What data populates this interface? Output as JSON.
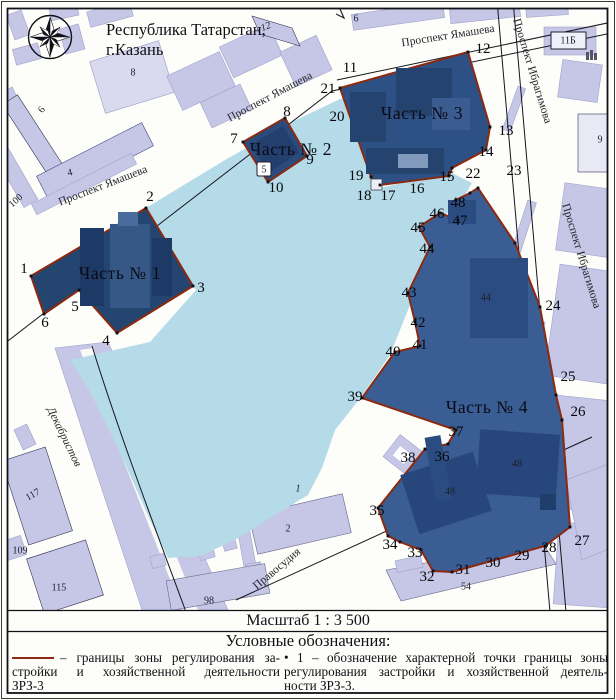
{
  "title": {
    "line1": "Республика Татарстан,",
    "line2": "г.Казань"
  },
  "scale_label": "Масштаб 1 : 3 500",
  "legend": {
    "title": "Условные обозначения:",
    "left_lines": [
      "– границы зоны регулирования за-",
      "стройки и хозяйственной деятельности",
      "ЗРЗ-3"
    ],
    "right_lines": [
      "• 1 – обозначение характерной точки границы зоны",
      "регулирования застройки и хозяйственной деятель-",
      "ности ЗРЗ-3."
    ]
  },
  "colors": {
    "zone_boundary": "#8b2a10",
    "zone_fill_1": "#24456f",
    "zone_fill_2": "#2a4b7c",
    "zone_fill_3": "#2d5085",
    "zone_fill_4": "#3a5d94",
    "city_block": "#c6c6e6",
    "open_area": "#b5dbe8"
  },
  "map": {
    "zones": [
      [
        "Часть № 1",
        120,
        273
      ],
      [
        "Часть № 2",
        291,
        149
      ],
      [
        "Часть № 3",
        422,
        113
      ],
      [
        "Часть № 4",
        487,
        407
      ]
    ],
    "streets": [
      [
        "Проспект Ямашева",
        103,
        186,
        -21,
        false
      ],
      [
        "Проспект Ямашева",
        270,
        97,
        -28,
        false
      ],
      [
        "Проспект Ямашева",
        448,
        36,
        -9,
        false
      ],
      [
        "Проспект Ибрагимова",
        532,
        71,
        73,
        false
      ],
      [
        "Проспект Ибрагимова",
        581,
        256,
        73,
        false
      ],
      [
        "Декабристов",
        64,
        437,
        64,
        true
      ],
      [
        "Правосудия",
        277,
        569,
        -40,
        false
      ]
    ],
    "points": [
      [
        "1",
        24,
        269
      ],
      [
        "2",
        150,
        197
      ],
      [
        "3",
        201,
        288
      ],
      [
        "4",
        106,
        341
      ],
      [
        "5",
        75,
        307
      ],
      [
        "6",
        45,
        323
      ],
      [
        "7",
        234,
        139
      ],
      [
        "8",
        287,
        112
      ],
      [
        "9",
        310,
        160
      ],
      [
        "10",
        276,
        188
      ],
      [
        "11",
        350,
        68
      ],
      [
        "12",
        483,
        49
      ],
      [
        "13",
        506,
        131
      ],
      [
        "14",
        486,
        152
      ],
      [
        "15",
        447,
        177
      ],
      [
        "16",
        417,
        189
      ],
      [
        "17",
        388,
        196
      ],
      [
        "18",
        364,
        196
      ],
      [
        "19",
        356,
        176
      ],
      [
        "20",
        337,
        117
      ],
      [
        "21",
        328,
        89
      ],
      [
        "22",
        473,
        174
      ],
      [
        "23",
        514,
        171
      ],
      [
        "24",
        553,
        306
      ],
      [
        "25",
        568,
        377
      ],
      [
        "26",
        578,
        412
      ],
      [
        "27",
        582,
        541
      ],
      [
        "28",
        549,
        548
      ],
      [
        "29",
        522,
        556
      ],
      [
        "30",
        493,
        563
      ],
      [
        "31",
        463,
        570
      ],
      [
        "32",
        427,
        577
      ],
      [
        "33",
        415,
        553
      ],
      [
        "34",
        390,
        545
      ],
      [
        "35",
        377,
        511
      ],
      [
        "36",
        442,
        457
      ],
      [
        "37",
        456,
        432
      ],
      [
        "38",
        408,
        458
      ],
      [
        "39",
        355,
        397
      ],
      [
        "40",
        393,
        352
      ],
      [
        "41",
        420,
        345
      ],
      [
        "42",
        418,
        323
      ],
      [
        "43",
        409,
        293
      ],
      [
        "44",
        427,
        249
      ],
      [
        "45",
        418,
        228
      ],
      [
        "46",
        437,
        214
      ],
      [
        "47",
        460,
        221
      ],
      [
        "48",
        458,
        203
      ]
    ],
    "buildings": [
      [
        "6",
        42,
        110,
        -52,
        false
      ],
      [
        "8",
        133,
        73,
        0,
        false
      ],
      [
        "4",
        70,
        173,
        -14,
        false
      ],
      [
        "12",
        266,
        27,
        -22,
        true
      ],
      [
        "6",
        356,
        19,
        0,
        false
      ],
      [
        "11Б",
        568,
        41,
        0,
        false
      ],
      [
        "9",
        600,
        140,
        0,
        false
      ],
      [
        "100",
        16,
        201,
        -42,
        false
      ],
      [
        "117",
        33,
        495,
        -30,
        false
      ],
      [
        "109",
        20,
        551,
        0,
        false
      ],
      [
        "115",
        59,
        588,
        0,
        false
      ],
      [
        "98",
        209,
        601,
        0,
        false
      ],
      [
        "1",
        298,
        489,
        0,
        true
      ],
      [
        "2",
        288,
        529,
        0,
        false
      ],
      [
        "54",
        466,
        587,
        0,
        false
      ],
      [
        "5",
        264,
        170,
        0,
        false
      ],
      [
        "44",
        486,
        298,
        0,
        false
      ],
      [
        "48",
        517,
        464,
        0,
        false
      ],
      [
        "48",
        450,
        492,
        0,
        false
      ]
    ]
  }
}
